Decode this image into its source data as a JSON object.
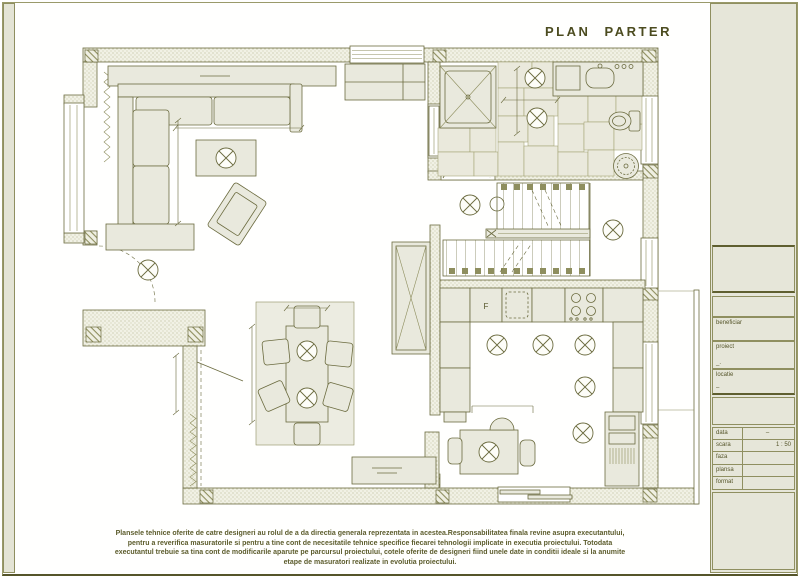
{
  "page": {
    "title": "PLAN PARTER"
  },
  "colors": {
    "line": "#6b6b3f",
    "line_dark": "#4c4c20",
    "furniture_fill": "#e9e9dd",
    "panel_bg": "#e6e6d9",
    "hatch": "#8e8e5e",
    "text": "#5c5c2c"
  },
  "title_block": {
    "sections": [
      {
        "label": "beneficiar",
        "value": ""
      },
      {
        "label": "proiect",
        "value": "_."
      },
      {
        "label": "locatie",
        "value": "–"
      }
    ],
    "rows": [
      {
        "label": "data",
        "value": "–"
      },
      {
        "label": "scara",
        "value": "1 : 50"
      },
      {
        "label": "faza",
        "value": ""
      },
      {
        "label": "plansa",
        "value": ""
      },
      {
        "label": "format",
        "value": ""
      }
    ]
  },
  "plan": {
    "fridge_label": "F"
  },
  "icons": {
    "ceiling_light_icon": "circled-x",
    "pendant_light_icon": "circled-x"
  },
  "disclaimer": {
    "lines": [
      "Plansele tehnice oferite de catre designeri au rolul de a da directia generala reprezentata in acestea.Responsabilitatea finala revine asupra executantului,",
      "pentru a reverifica masuratorile si pentru a tine cont de necesitatile tehnice specifice fiecarei tehnologii implicate in executia proiectului. Totodata",
      "executantul trebuie sa tina cont de modificarile aparute pe parcursul proiectului, cotele oferite de designeri fiind unele date in conditii ideale si la anumite",
      "etape de masuratori realizate in evolutia proiectului."
    ]
  }
}
